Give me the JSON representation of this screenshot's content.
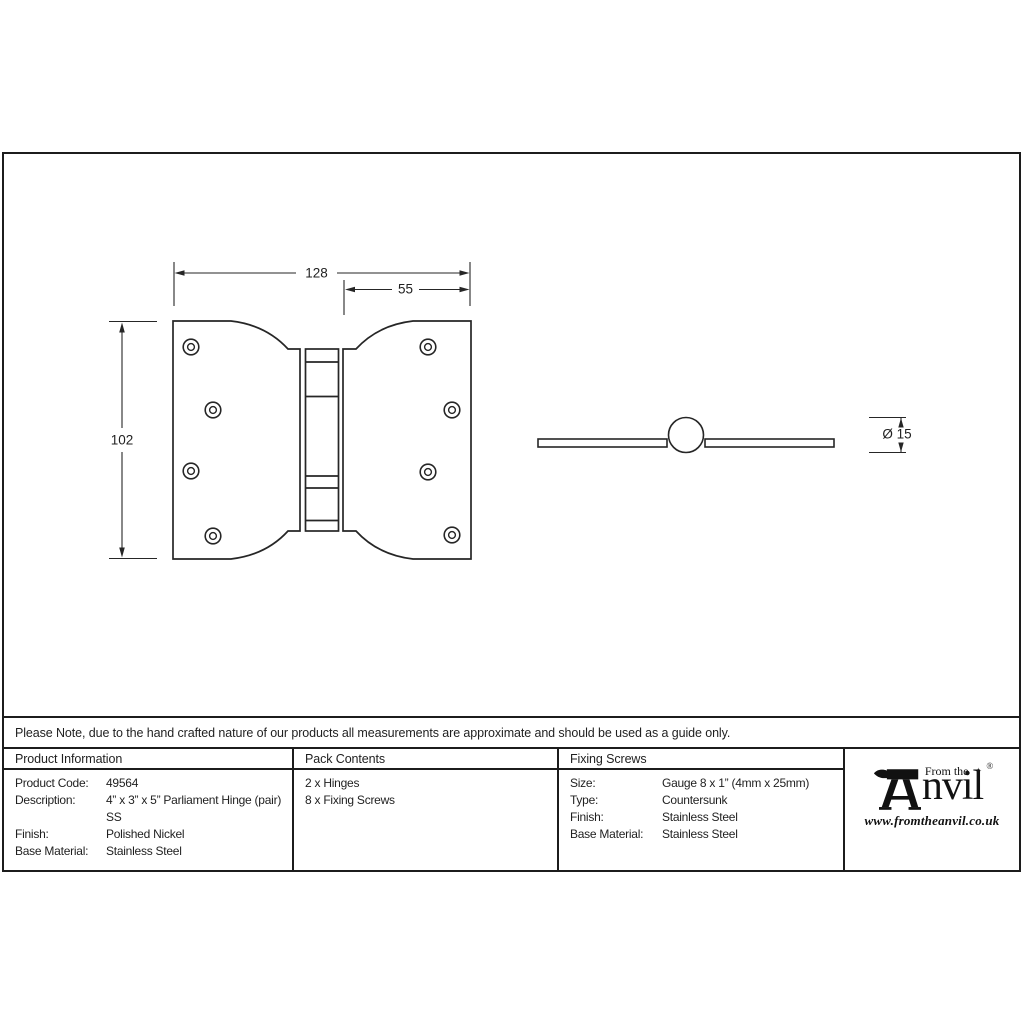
{
  "note": "Please Note, due to the hand crafted nature of our products all measurements are approximate and should be used as a guide only.",
  "drawing": {
    "front_view": {
      "width_label": "128",
      "right_flap_label": "55",
      "height_label": "102"
    },
    "side_view": {
      "diameter_label": "Ø 15"
    }
  },
  "table": {
    "product_information": {
      "header": "Product Information",
      "rows": [
        {
          "label": "Product Code:",
          "value": "49564"
        },
        {
          "label": "Description:",
          "value": "4” x 3” x 5” Parliament Hinge (pair)"
        },
        {
          "label": "",
          "value": "SS"
        },
        {
          "label": "Finish:",
          "value": "Polished Nickel"
        },
        {
          "label": "Base Material:",
          "value": "Stainless Steel"
        }
      ]
    },
    "pack_contents": {
      "header": "Pack Contents",
      "items": [
        "2 x Hinges",
        "8 x Fixing Screws"
      ]
    },
    "fixing_screws": {
      "header": "Fixing Screws",
      "rows": [
        {
          "label": "Size:",
          "value": "Gauge 8 x 1” (4mm x 25mm)"
        },
        {
          "label": "Type:",
          "value": "Countersunk"
        },
        {
          "label": "Finish:",
          "value": "Stainless Steel"
        },
        {
          "label": "Base Material:",
          "value": "Stainless Steel"
        }
      ]
    }
  },
  "logo": {
    "tagline": "From the",
    "diamond": "✦",
    "brand": "nvil",
    "registered": "®",
    "url": "www.fromtheanvil.co.uk"
  }
}
